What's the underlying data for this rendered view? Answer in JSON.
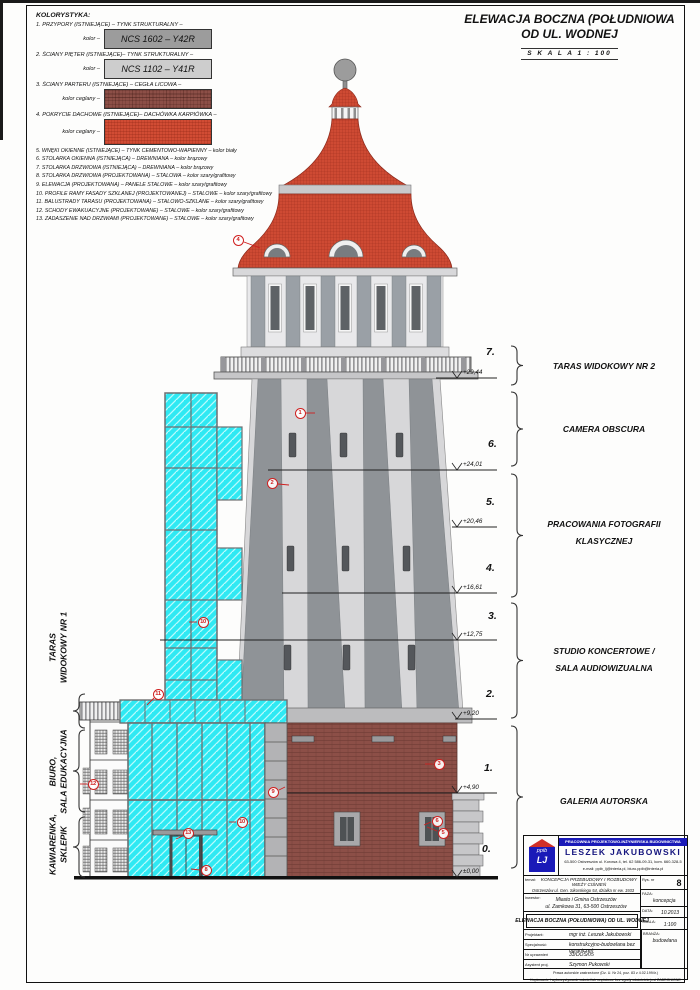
{
  "colors": {
    "roof_red": "#ce4a33",
    "brick": "#8c4f47",
    "glass_cyan": "#2fe9f3",
    "ncs_1602_gray": "#9c9c9c",
    "ncs_1102_gray": "#cdcdcd",
    "marker_red": "#cf2020",
    "logo_blue": "#1a1ab8"
  },
  "legend": {
    "title": "KOLORYSTYKA:",
    "i1": "1. PRZYPORY (ISTNIEJĄCE) – TYNK STRUKTURALNY –",
    "i1k": "kolor –",
    "i1s": "NCS 1602 – Y42R",
    "i2": "2. ŚCIANY PIĘTER (ISTNIEJĄCE)– TYNK STRUKTURALNY –",
    "i2k": "kolor –",
    "i2s": "NCS 1102 – Y41R",
    "i3": "3. ŚCIANY PARTERU (ISTNIEJĄCE) – CEGŁA LICOWA –",
    "i3k": "kolor ceglany –",
    "i4": "4. POKRYCIE DACHOWE (ISTNIEJĄCE)– DACHÓWKA KARPIÓWKA –",
    "i4k": "kolor ceglany –",
    "i5": "5. WNĘKI OKIENNE (ISTNIEJĄCE) – TYNK CEMENTOWO-WAPIENNY – kolor biały",
    "i6": "6. STOLARKA OKIENNA (ISTNIEJĄCA) – DREWNIANA – kolor brązowy",
    "i7": "7. STOLARKA DRZWIOWA (ISTNIEJĄCA) – DREWNIANA – kolor brązowy",
    "i8": "8. STOLARKA DRZWIOWA (PROJEKTOWANA) – STALOWA – kolor szary/grafitowy",
    "i9": "9. ELEWACJA (PROJEKTOWANA) – PANELE STALOWE – kolor szary/grafitowy",
    "i10": "10. PROFILE RAMY FASADY SZKLANEJ (PROJEKTOWANEJ) – STALOWE – kolor szary/grafitowy",
    "i11": "11. BALUSTRADY TARASU (PROJEKTOWANA) – STALOWO-SZKLANE – kolor szary/grafitowy",
    "i12": "12. SCHODY EWAKUACYJNE (PROJEKTOWANE) – STALOWE – kolor szary/grafitowy",
    "i13": "13. ZADASZENIE NAD DRZWIAMI (PROJEKTOWANE) – STALOWE – kolor szary/grafitowy"
  },
  "title_top": {
    "line1": "ELEWACJA BOCZNA (POŁUDNIOWA",
    "line2": "OD UL. WODNEJ",
    "scale": "S K A L A   1 : 100"
  },
  "levels": {
    "n7": "7.",
    "e7": "+29,44",
    "n6": "6.",
    "e6": "+24,01",
    "n5": "5.",
    "e5": "+20,46",
    "n4": "4.",
    "e4": "+16,61",
    "n3": "3.",
    "e3": "+12,75",
    "n2": "2.",
    "e2": "+9,20",
    "n1": "1.",
    "e1": "+4,90",
    "n0": "0.",
    "e0": "±0,00"
  },
  "right_labels": {
    "r1": "TARAS WIDOKOWY NR 2",
    "r2": "CAMERA OBSCURA",
    "r3a": "PRACOWANIA FOTOGRAFII",
    "r3b": "KLASYCZNEJ",
    "r4a": "STUDIO KONCERTOWE /",
    "r4b": "SALA AUDIOWIZUALNA",
    "r5": "GALERIA AUTORSKA"
  },
  "left_labels": {
    "l1a": "TARAS",
    "l1b": "WIDOKOWY NR 1",
    "l2a": "BIURO,",
    "l2b": "SALA EDUKACYJNA",
    "l3a": "KAWIARENKA,",
    "l3b": "SKLEPIK"
  },
  "markers": {
    "m1": "1",
    "m2": "2",
    "m3": "3",
    "m4": "4",
    "m5": "5",
    "m6": "6",
    "m8": "8",
    "m9": "9",
    "m10a": "10",
    "m10b": "10",
    "m11": "11",
    "m12": "12",
    "m13": "13"
  },
  "title_block": {
    "company_line": "PRACOWNIA PROJEKTOWO-INŻYNIERSKA BUDOWNICTWA",
    "owner": "LESZEK JAKUBOWSKI",
    "address": "63-500 Ostrzeszów ul. Korowa 4, tel. 62 586-09-31, kom. 660-328-5",
    "email": "e-mail: ppib_lj@interia.pl, biuro.ppib@interia.pl",
    "logo_top": "ppib",
    "logo_bottom": "LJ",
    "temat_label": "temat:",
    "temat1": "KONCEPCJA PRZEBUDOWY I ROZBUDOWY",
    "temat2": "WIEŻY CIŚNIEŃ",
    "temat3": "Ostrzeszów ul. Gen. Sikorskiego 54, działka nr ew. 1933",
    "inwestor_label": "inwestor:",
    "inwestor1": "Miasto i Gmina Ostrzeszów",
    "inwestor2": "ul. Zamkowa 31, 63-500 Ostrzeszów",
    "rysnr_label": "Rys. nr",
    "rysnr": "8",
    "faza_label": "FAZA:",
    "faza": "koncepcja",
    "data_label": "DATA:",
    "data": "10.2013",
    "skala_label": "SKALA:",
    "skala": "1:100",
    "branza_label": "BRANŻA:",
    "branza": "budowlana",
    "drawing_title": "ELEWACJA BOCZNA (POŁUDNIOWA) OD UL. WODNEJ",
    "projektant_label": "Projektant:",
    "projektant": "mgr inż. Leszek Jakubowski",
    "specjalnosc_label": "Specjalność:",
    "specjalnosc": "konstrukcyjno-budowlana bez ograniczeń",
    "uprawnienia_label": "Nr uprawnień",
    "uprawnienia": "33/DOŚ/05",
    "asystent_label": "Asystent proj.",
    "asystent": "Szymon Pukowski",
    "footer1": "Prawa autorskie zastrzeżone (Dz. U. Nr 24, poz. 83 z 4.02.1994r.)",
    "footer2": "Kopiowanie i wykorzystywanie całości lub częściowe bez zgody właściciela jest ZABRONIONE"
  }
}
